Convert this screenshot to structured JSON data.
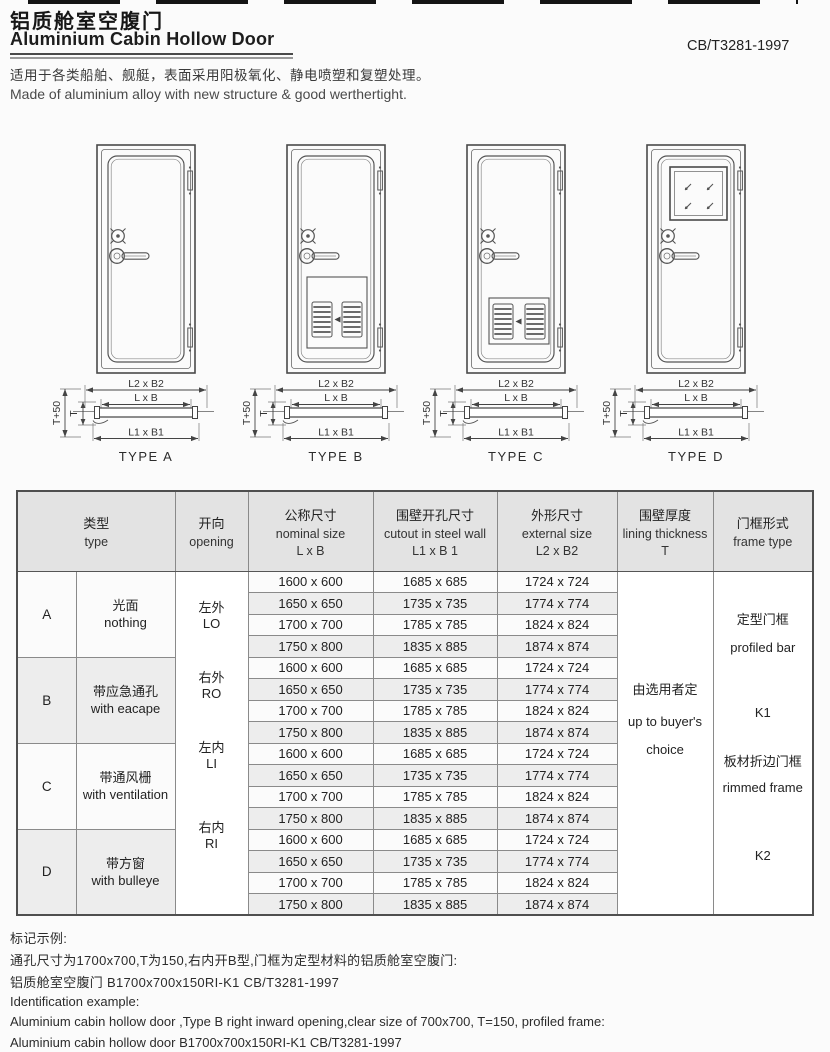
{
  "header": {
    "title_cn": "铝质舱室空腹门",
    "title_en": "Aluminium Cabin Hollow Door",
    "standard": "CB/T3281-1997",
    "desc_cn": "适用于各类船舶、舰艇，表面采用阳极氧化、静电喷塑和复塑处理。",
    "desc_en": "Made of aluminium alloy with new structure & good werthertight."
  },
  "diagrams": {
    "dim_outer": "L2 x B2",
    "dim_nominal": "L x B",
    "dim_cutout": "L1 x B1",
    "dim_t_plus": "T+50",
    "dim_t": "T",
    "types": [
      {
        "label": "TYPE A"
      },
      {
        "label": "TYPE B"
      },
      {
        "label": "TYPE C"
      },
      {
        "label": "TYPE D"
      }
    ]
  },
  "table": {
    "headers": {
      "type_cn": "类型",
      "type_en": "type",
      "opening_cn": "开向",
      "opening_en": "opening",
      "nominal_cn": "公称尺寸",
      "nominal_en": "nominal size",
      "nominal_dim": "L x B",
      "cutout_cn": "围壁开孔尺寸",
      "cutout_en": "cutout in steel wall",
      "cutout_dim": "L1 x B 1",
      "external_cn": "外形尺寸",
      "external_en": "external  size",
      "external_dim": "L2 x B2",
      "lining_cn": "围壁厚度",
      "lining_en": "lining thickness",
      "lining_dim": "T",
      "frame_cn": "门框形式",
      "frame_en": "frame type"
    },
    "groups": [
      {
        "letter": "A",
        "desc_cn": "光面",
        "desc_en": "nothing"
      },
      {
        "letter": "B",
        "desc_cn": "带应急通孔",
        "desc_en": "with eacape"
      },
      {
        "letter": "C",
        "desc_cn": "带通风栅",
        "desc_en": "with ventilation"
      },
      {
        "letter": "D",
        "desc_cn": "带方窗",
        "desc_en": "with bulleye"
      }
    ],
    "openings": [
      {
        "cn": "左外",
        "code": "LO"
      },
      {
        "cn": "右外",
        "code": "RO"
      },
      {
        "cn": "左内",
        "code": "LI"
      },
      {
        "cn": "右内",
        "code": "RI"
      }
    ],
    "sizes": [
      {
        "nominal": "1600 x 600",
        "cutout": "1685 x 685",
        "external": "1724 x 724"
      },
      {
        "nominal": "1650 x 650",
        "cutout": "1735 x 735",
        "external": "1774 x 774"
      },
      {
        "nominal": "1700 x 700",
        "cutout": "1785 x 785",
        "external": "1824 x 824"
      },
      {
        "nominal": "1750 x 800",
        "cutout": "1835 x 885",
        "external": "1874 x 874"
      }
    ],
    "lining": [
      "由选用者定",
      "up to buyer's",
      "choice"
    ],
    "frame": [
      "定型门框",
      "profiled bar",
      "K1",
      "板材折边门框",
      "rimmed frame",
      "K2"
    ]
  },
  "notes": {
    "cn_title": "标记示例:",
    "cn_line1": "通孔尺寸为1700x700,T为150,右内开B型,门框为定型材料的铝质舱室空腹门:",
    "cn_line2": "铝质舱室空腹门 B1700x700x150RI-K1 CB/T3281-1997",
    "en_title": "Identification example:",
    "en_line1": "Aluminium cabin hollow door ,Type B right inward opening,clear size of 700x700, T=150, profiled frame:",
    "en_line2": "Aluminium cabin hollow door B1700x700x150RI-K1 CB/T3281-1997"
  }
}
